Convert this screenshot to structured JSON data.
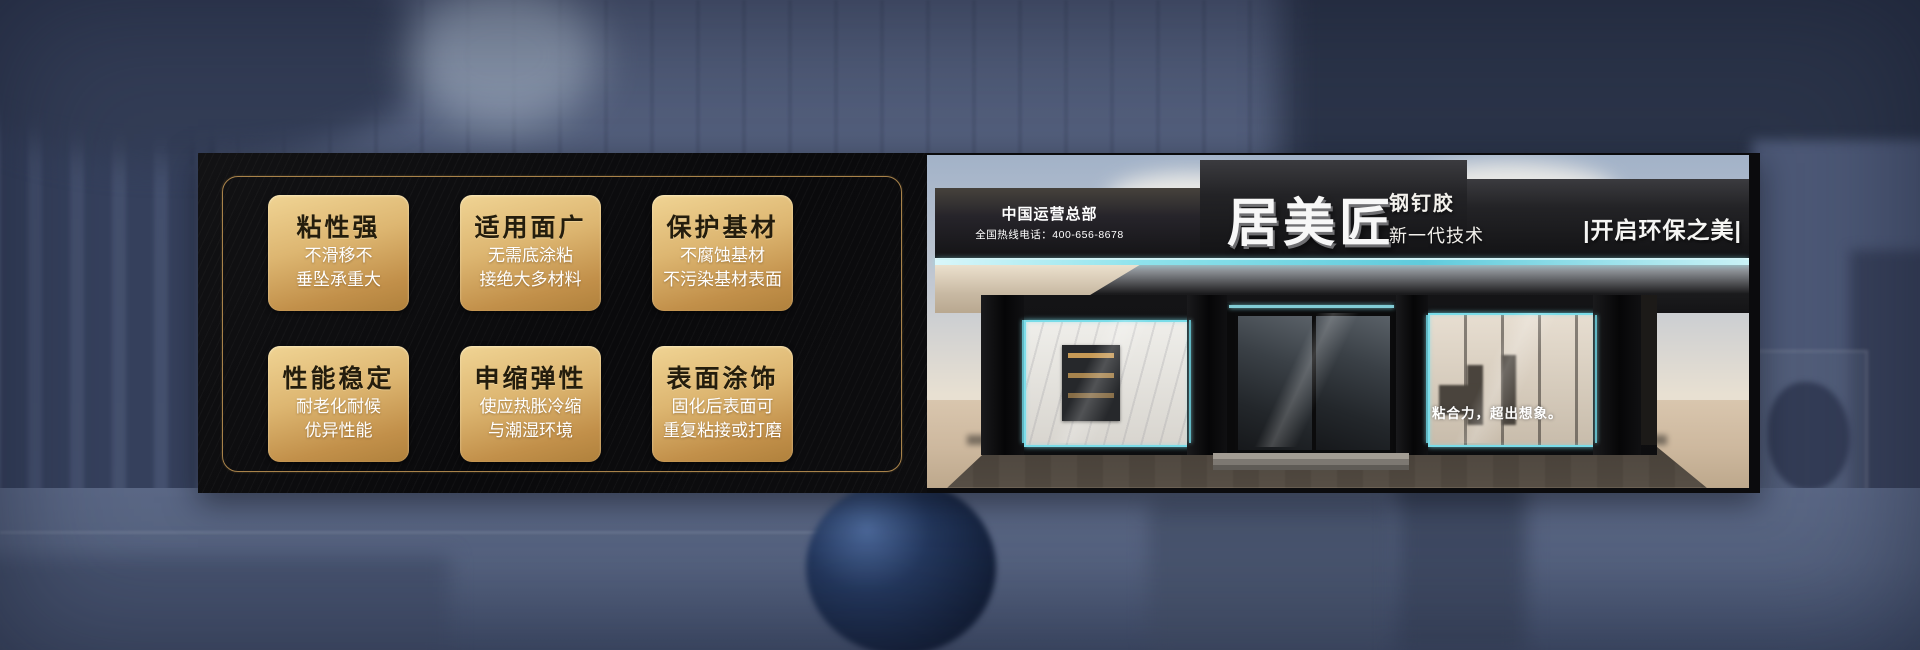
{
  "accent_colors": {
    "gold_border": "#a8824a",
    "card_gradient_top": "#f0d494",
    "card_gradient_bottom": "#b0813c",
    "led_cyan": "#7adce8",
    "panel_black": "#0b0b0d"
  },
  "features": {
    "cards": [
      {
        "title": "粘性强",
        "line1": "不滑移不",
        "line2": "垂坠承重大"
      },
      {
        "title": "适用面广",
        "line1": "无需底涂粘",
        "line2": "接绝大多材料"
      },
      {
        "title": "保护基材",
        "line1": "不腐蚀基材",
        "line2": "不污染基材表面"
      },
      {
        "title": "性能稳定",
        "line1": "耐老化耐候",
        "line2": "优异性能"
      },
      {
        "title": "申缩弹性",
        "line1": "使应热胀冷缩",
        "line2": "与潮湿环境"
      },
      {
        "title": "表面涂饰",
        "line1": "固化后表面可",
        "line2": "重复粘接或打磨"
      }
    ]
  },
  "storefront": {
    "hq": "中国运营总部",
    "hotline": "全国热线电话：400-656-8678",
    "brand": "居美匠",
    "product": "钢钉胶",
    "technology": "新一代技术",
    "right_slogan": "|开启环保之美|",
    "window_slogan": "粘合力，超出想象。"
  }
}
